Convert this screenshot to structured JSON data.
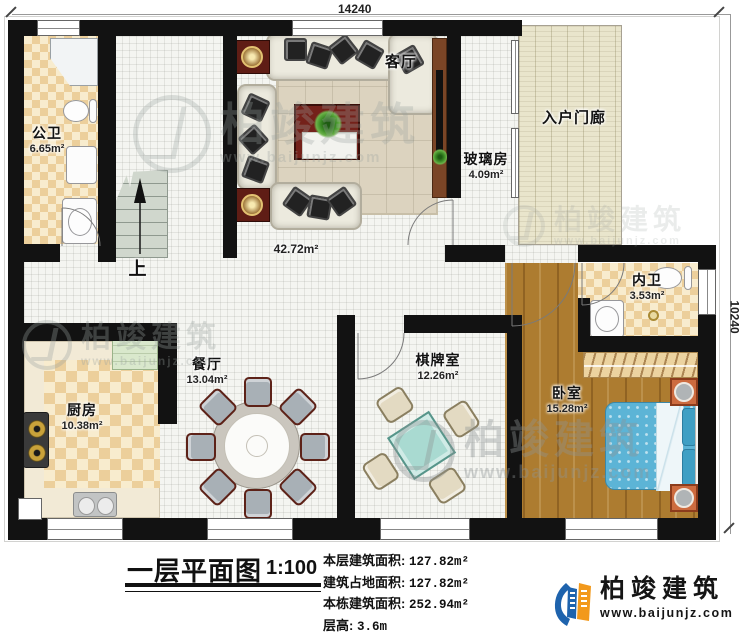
{
  "dimension_labels": {
    "top": "14240",
    "right": "10240"
  },
  "rooms": {
    "public_bath": {
      "name": "公卫",
      "area": "6.65m²"
    },
    "living": {
      "name": "客厅",
      "area": "42.72m²"
    },
    "glass": {
      "name": "玻璃房",
      "area": "4.09m²"
    },
    "porch": {
      "name": "入户门廊"
    },
    "inner_bath": {
      "name": "内卫",
      "area": "3.53m²"
    },
    "dining": {
      "name": "餐厅",
      "area": "13.04m²"
    },
    "kitchen": {
      "name": "厨房",
      "area": "10.38m²"
    },
    "game": {
      "name": "棋牌室",
      "area": "12.26m²"
    },
    "bedroom": {
      "name": "卧室",
      "area": "15.28m²"
    },
    "stairs": {
      "up": "上"
    }
  },
  "footer": {
    "title": "一层平面图",
    "scale": "1:100",
    "stats": [
      {
        "label": "本层建筑面积:",
        "value": "127.82m²"
      },
      {
        "label": "建筑占地面积:",
        "value": "127.82m²"
      },
      {
        "label": "本栋建筑面积:",
        "value": "252.94m²"
      },
      {
        "label": "层高:",
        "value": "3.6m"
      }
    ],
    "brand": {
      "name": "柏竣建筑",
      "url": "www.baijunjz.com"
    }
  },
  "watermark": {
    "name": "柏竣建筑",
    "url": "www.baijunjz.com"
  },
  "colors": {
    "wall": "#121212",
    "brand_blue": "#1e63ad",
    "brand_orange": "#f2991c",
    "wood": "#ad7c30",
    "bed": "#5cb4d6"
  }
}
